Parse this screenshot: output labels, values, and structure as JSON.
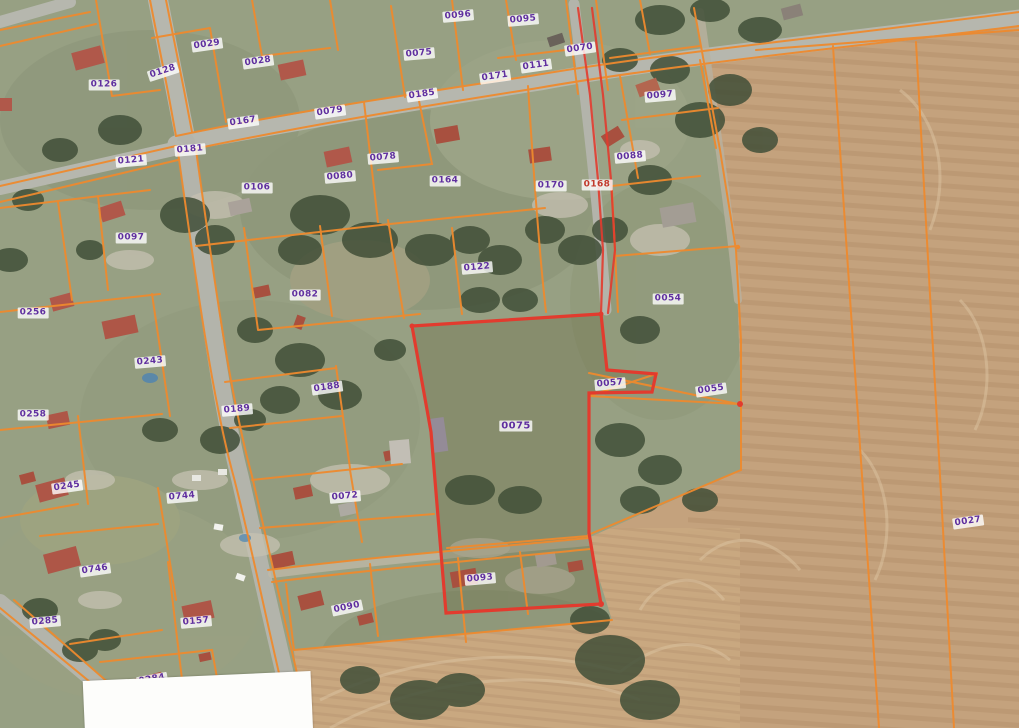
{
  "map": {
    "type": "cadastral-aerial-map",
    "highlighted_parcel": "0075",
    "colors": {
      "boundary_orange": "#ee8a2e",
      "highlight_red": "#e23b2e",
      "label_purple": "#5f2f9e",
      "label_red": "#c0392b",
      "label_bg": "rgba(255,255,255,0.8)",
      "field_tan": "#c4a27d",
      "village_green": "#97a083",
      "road_grey": "#b6b7ae"
    },
    "parcels": [
      {
        "n": "0029",
        "x": 207,
        "y": 45,
        "r": -8
      },
      {
        "n": "0028",
        "x": 258,
        "y": 62,
        "r": -8
      },
      {
        "n": "0126",
        "x": 104,
        "y": 85,
        "r": 0
      },
      {
        "n": "0128",
        "x": 163,
        "y": 72,
        "r": -18
      },
      {
        "n": "0096",
        "x": 458,
        "y": 16,
        "r": -5
      },
      {
        "n": "0095",
        "x": 523,
        "y": 20,
        "r": -5
      },
      {
        "n": "0075",
        "x": 419,
        "y": 54,
        "r": -5
      },
      {
        "n": "0070",
        "x": 580,
        "y": 49,
        "r": -8
      },
      {
        "n": "0079",
        "x": 330,
        "y": 112,
        "r": -8
      },
      {
        "n": "0167",
        "x": 243,
        "y": 122,
        "r": -8
      },
      {
        "n": "0185",
        "x": 422,
        "y": 95,
        "r": -8
      },
      {
        "n": "0171",
        "x": 495,
        "y": 77,
        "r": -8
      },
      {
        "n": "0111",
        "x": 536,
        "y": 66,
        "r": -8
      },
      {
        "n": "0097",
        "x": 660,
        "y": 96,
        "r": -5
      },
      {
        "n": "0088",
        "x": 630,
        "y": 157,
        "r": -5
      },
      {
        "n": "0168",
        "x": 597,
        "y": 185,
        "r": 0,
        "variant": "red"
      },
      {
        "n": "0170",
        "x": 551,
        "y": 186,
        "r": 0
      },
      {
        "n": "0164",
        "x": 445,
        "y": 181,
        "r": 0
      },
      {
        "n": "0078",
        "x": 383,
        "y": 158,
        "r": -5
      },
      {
        "n": "0080",
        "x": 340,
        "y": 177,
        "r": -5
      },
      {
        "n": "0181",
        "x": 190,
        "y": 150,
        "r": -5
      },
      {
        "n": "0121",
        "x": 131,
        "y": 161,
        "r": -5
      },
      {
        "n": "0106",
        "x": 257,
        "y": 188,
        "r": 0
      },
      {
        "n": "0097",
        "x": 131,
        "y": 238,
        "r": 0
      },
      {
        "n": "0122",
        "x": 477,
        "y": 268,
        "r": -5
      },
      {
        "n": "0082",
        "x": 305,
        "y": 295,
        "r": 0
      },
      {
        "n": "0256",
        "x": 33,
        "y": 313,
        "r": 0
      },
      {
        "n": "0243",
        "x": 150,
        "y": 362,
        "r": -5
      },
      {
        "n": "0258",
        "x": 33,
        "y": 415,
        "r": 0
      },
      {
        "n": "0188",
        "x": 327,
        "y": 388,
        "r": -8
      },
      {
        "n": "0189",
        "x": 237,
        "y": 410,
        "r": -5
      },
      {
        "n": "0054",
        "x": 668,
        "y": 299,
        "r": 0
      },
      {
        "n": "0057",
        "x": 610,
        "y": 384,
        "r": -5
      },
      {
        "n": "0055",
        "x": 711,
        "y": 390,
        "r": -8
      },
      {
        "n": "0075",
        "x": 516,
        "y": 426,
        "r": 0,
        "variant": "big"
      },
      {
        "n": "0027",
        "x": 968,
        "y": 522,
        "r": -8
      },
      {
        "n": "0245",
        "x": 67,
        "y": 487,
        "r": -8
      },
      {
        "n": "0744",
        "x": 182,
        "y": 497,
        "r": -5
      },
      {
        "n": "0072",
        "x": 345,
        "y": 497,
        "r": -5
      },
      {
        "n": "0746",
        "x": 95,
        "y": 570,
        "r": -8
      },
      {
        "n": "0285",
        "x": 45,
        "y": 622,
        "r": -5
      },
      {
        "n": "0157",
        "x": 196,
        "y": 622,
        "r": -5
      },
      {
        "n": "0284",
        "x": 152,
        "y": 680,
        "r": -10
      },
      {
        "n": "0090",
        "x": 347,
        "y": 608,
        "r": -12
      },
      {
        "n": "0093",
        "x": 480,
        "y": 579,
        "r": -5
      }
    ]
  }
}
